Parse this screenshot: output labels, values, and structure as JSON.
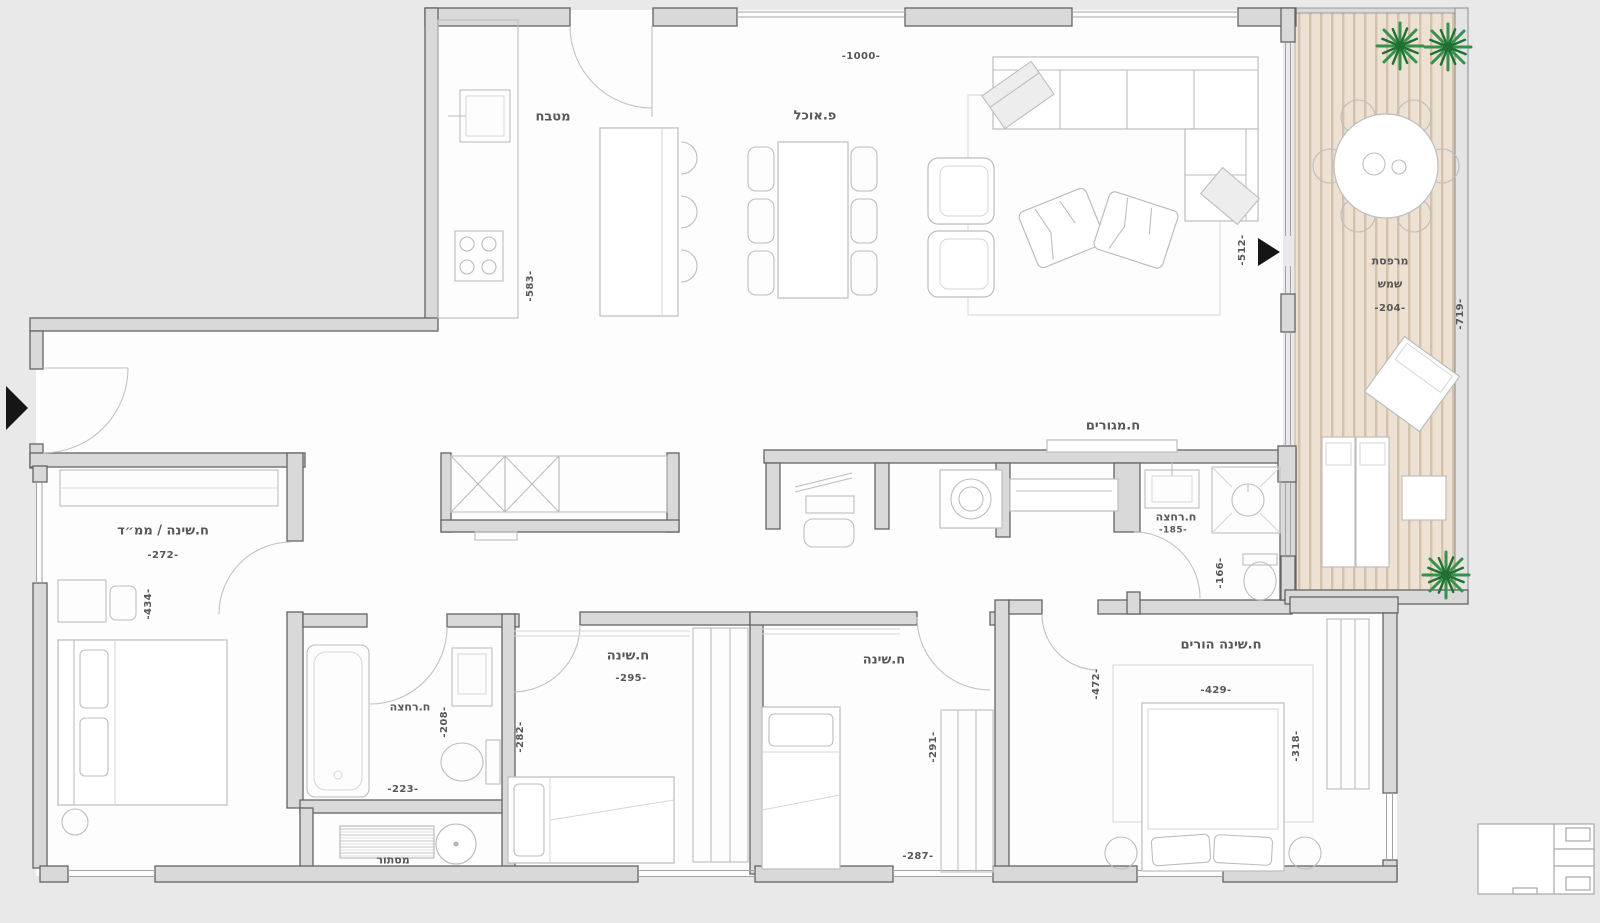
{
  "plan": {
    "rooms": {
      "kitchen": {
        "name": "מטבח"
      },
      "dining": {
        "name": "פ.אוכל"
      },
      "living": {
        "name": "ח.מגורים",
        "terrace_door_dim": "-512-"
      },
      "terrace": {
        "name_line1": "מרפסת",
        "name_line2": "שמש",
        "width_dim": "-204-",
        "height_dim": "-719-"
      },
      "bedroom_mamad": {
        "name": "ח.שינה / ממ״ד",
        "width_dim": "-272-",
        "height_dim": "-434-"
      },
      "bathroom_left": {
        "name": "ח.רחצה",
        "depth_dim": "-208-",
        "width_dim": "-223-"
      },
      "bedroom_2": {
        "name": "ח.שינה",
        "width_dim": "-295-",
        "height_dim": "-282-"
      },
      "bedroom_3": {
        "name": "ח.שינה",
        "height_dim": "-291-",
        "width_dim": "-287-"
      },
      "bedroom_parents": {
        "name": "ח.שינה הורים",
        "width_dim": "-429-",
        "height_dim_left": "-472-",
        "height_dim_right": "-318-"
      },
      "bathroom_right": {
        "name": "ח.רחצה",
        "width_dim": "-185-",
        "height_dim": "-166-"
      },
      "laundry_screen": {
        "name": "מסתור"
      }
    },
    "dimensions": {
      "top_width": "-1000-",
      "kitchen_height": "-583-"
    },
    "colors": {
      "wall_fill": "#d9d9d9",
      "wall_stroke": "#646464",
      "deck_base": "#ece1d3",
      "deck_plank": "#d3c2ac",
      "plant_green": "#35924a",
      "label_text": "#575757",
      "arrow_black": "#151515"
    }
  }
}
